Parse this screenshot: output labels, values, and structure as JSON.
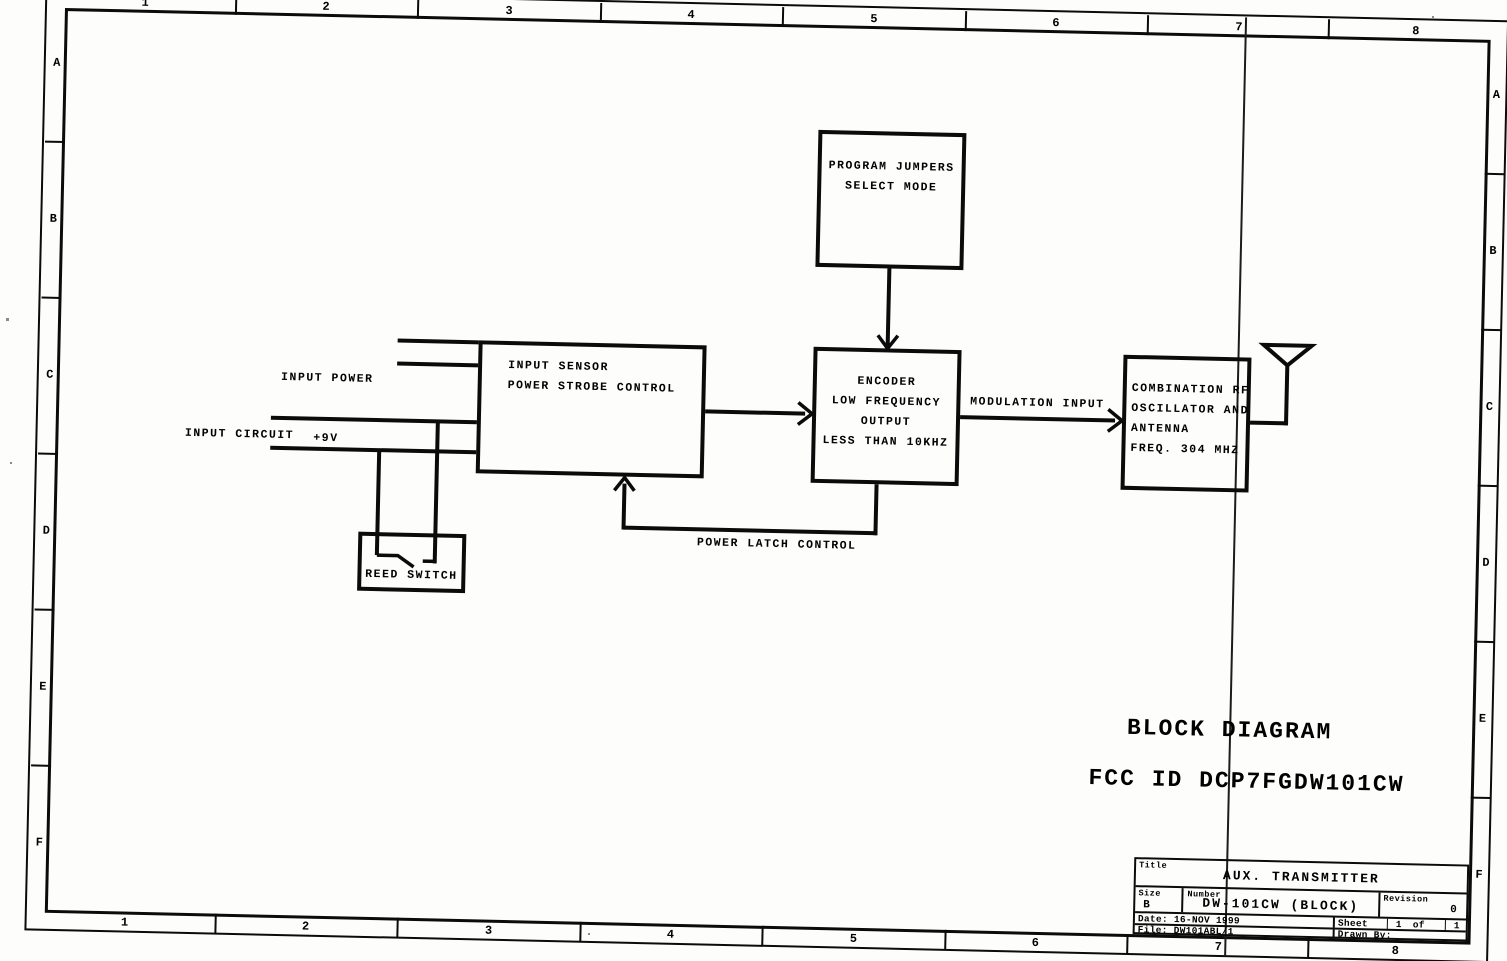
{
  "meta": {
    "document_type": "scanned schematic sheet",
    "background_color": "#fdfdfc",
    "line_color": "#0b0b0b"
  },
  "zones": {
    "columns": [
      "1",
      "2",
      "3",
      "4",
      "5",
      "6",
      "7",
      "8"
    ],
    "rows": [
      "A",
      "B",
      "C",
      "D",
      "E",
      "F"
    ]
  },
  "blocks": {
    "program_jumpers": {
      "lines": [
        "PROGRAM JUMPERS",
        "SELECT MODE"
      ]
    },
    "input_sensor": {
      "lines": [
        "INPUT SENSOR",
        "POWER STROBE CONTROL"
      ]
    },
    "encoder": {
      "lines": [
        "ENCODER",
        "LOW FREQUENCY",
        "OUTPUT",
        "LESS THAN 10KHZ"
      ]
    },
    "rf_oscillator": {
      "lines": [
        "COMBINATION RF",
        "OSCILLATOR AND",
        "ANTENNA",
        "FREQ. 304 MHZ"
      ]
    },
    "reed_switch": {
      "label": "REED SWITCH"
    }
  },
  "wires": {
    "input_power_line1": "INPUT POWER",
    "input_power_line2": "+9V",
    "input_circuit": "INPUT CIRCUIT",
    "modulation": "MODULATION INPUT",
    "power_latch": "POWER LATCH CONTROL"
  },
  "titles": {
    "block_diagram": "BLOCK DIAGRAM",
    "fcc_id": "FCC ID DCP7FGDW101CW"
  },
  "title_block": {
    "title_label": "Title",
    "title": "AUX. TRANSMITTER",
    "size_label": "Size",
    "size": "B",
    "number_label": "Number",
    "number": "DW-101CW (BLOCK)",
    "revision_label": "Revision",
    "revision": "0",
    "date": "Date: 16-NOV 1999",
    "file": "File: DW101ABL/1",
    "sheet_label": "Sheet",
    "sheet_page": "1",
    "sheet_of": "of",
    "sheet_total": "1",
    "drawn_by_label": "Drawn By:"
  }
}
